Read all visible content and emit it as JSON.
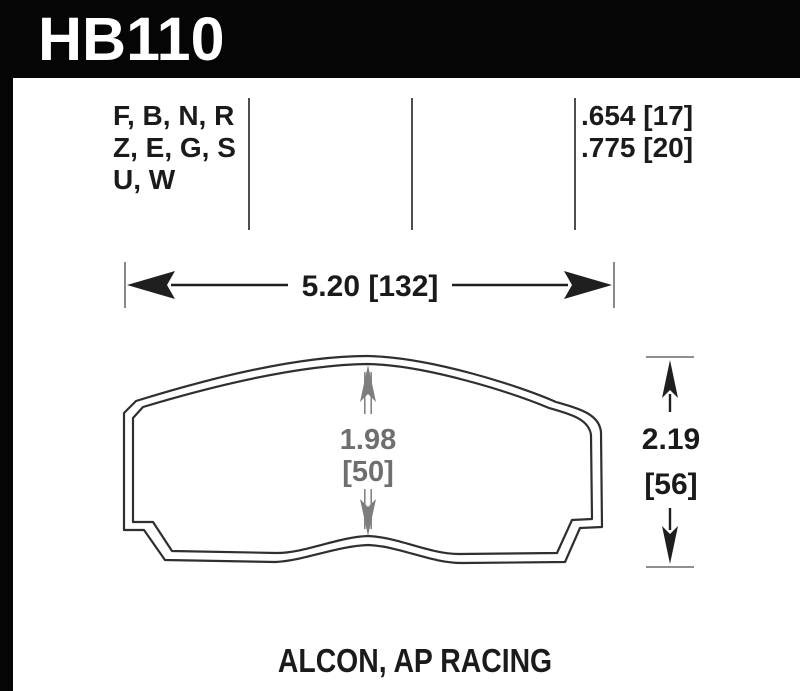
{
  "part_number": "HB110",
  "spec": {
    "compounds": [
      "F, B, N, R",
      "Z, E, G, S",
      "U, W"
    ],
    "thickness": [
      ".654 [17]",
      ".775 [20]"
    ]
  },
  "dimensions": {
    "width_label": "5.20 [132]",
    "center_height_value": "1.98",
    "center_height_bracket": "[50]",
    "overall_height_value": "2.19",
    "overall_height_bracket": "[56]"
  },
  "applications": "ALCON, AP RACING",
  "colors": {
    "background": "#000000",
    "panel": "#ffffff",
    "ink": "#1b1b1b",
    "dim_gray": "#6f6f6f"
  }
}
